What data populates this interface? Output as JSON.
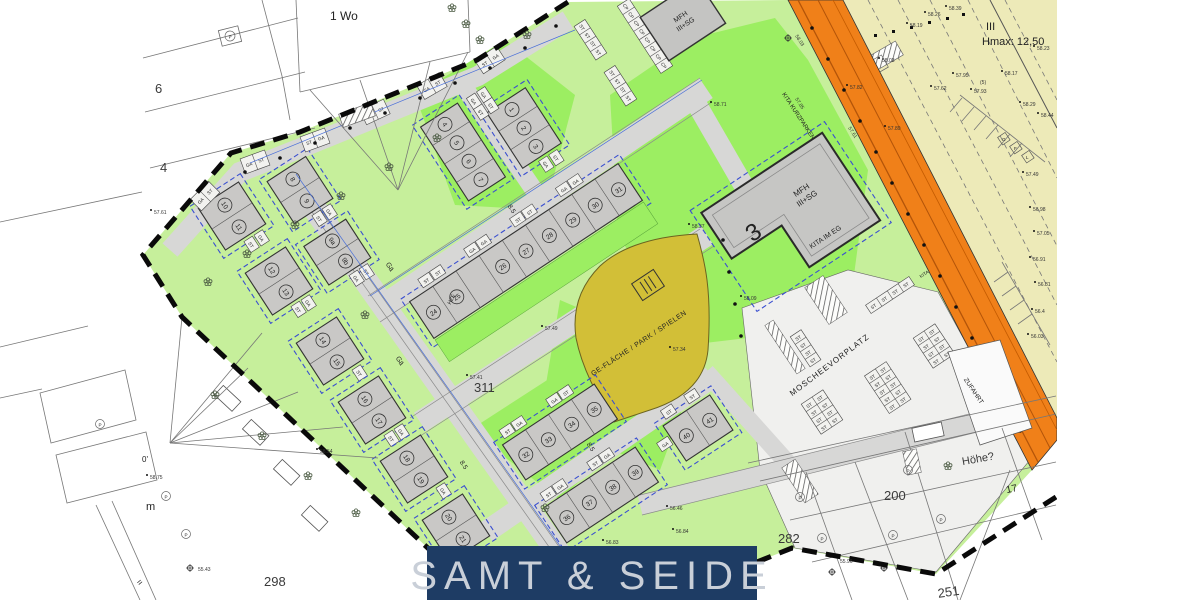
{
  "banner": {
    "title": "SAMT & SEIDE"
  },
  "units": {
    "ga": "GA",
    "st": "ST",
    "cp": "CP",
    "hze": "HZE",
    "kita": "KITA"
  },
  "houses": [
    "1",
    "2",
    "3",
    "4",
    "5",
    "6",
    "7",
    "8",
    "9",
    "9a",
    "9b",
    "10",
    "11",
    "12",
    "13",
    "14",
    "15",
    "16",
    "17",
    "18",
    "19",
    "20",
    "21",
    "24",
    "25",
    "26",
    "27",
    "28",
    "29",
    "30",
    "31",
    "32",
    "33",
    "34",
    "35",
    "36",
    "37",
    "38",
    "39",
    "40",
    "41"
  ],
  "parcels": {
    "p3": "3",
    "p4": "4",
    "p6": "6",
    "p17": "17",
    "p200": "200",
    "p251": "251",
    "p282": "282",
    "p298": "298",
    "p311": "311",
    "p5": "(5)",
    "wo": "1 Wo",
    "m": "m",
    "eq": "=",
    "deg": "0'",
    "hoehe": "Höhe?"
  },
  "areas": {
    "mfh": "MFH",
    "mfh_floors": "III+SG",
    "kita_eg": "KITA IM EG",
    "park": "GE-FLÄCHE / PARK / SPIELEN",
    "mosque": "MOSCHEEVORPLATZ",
    "zufahrt": "ZUFAHRT",
    "kurzparken": "KITA KURZPARKEN",
    "floors": "III",
    "hmax": "Hmax: 12,50",
    "street": "Gä",
    "width": "8.5",
    "p_sym": "P",
    "g": "G",
    "f": "F",
    "l": "L"
  },
  "elevations": [
    "58.39",
    "58.26",
    "58.19",
    "58.23",
    "58.03",
    "57.95",
    "58.17",
    "57.82",
    "57.62",
    "57.89",
    "58.29",
    "58.44",
    "57.49",
    "56.98",
    "57.05",
    "56.91",
    "56.81",
    "56.4",
    "56.03",
    "58.03",
    "57.85",
    "57.61",
    "58.71",
    "58.37",
    "58.09",
    "57.49",
    "57.41",
    "57.34",
    "58.54",
    "58.75",
    "55.43",
    "57.61",
    "56.84",
    "56.46",
    "56.83",
    "55.96",
    "57.93"
  ],
  "colors": {
    "orange_road": "#f08019",
    "plot_green": "#c6ef9b",
    "garden_green": "#9cee62",
    "road_gray": "#d7d7d6",
    "olive_park": "#d2bf37",
    "beige_area": "#edeab8",
    "banner_navy": "#1e3c64",
    "baugrenze_blue": "#3a4fd0"
  }
}
